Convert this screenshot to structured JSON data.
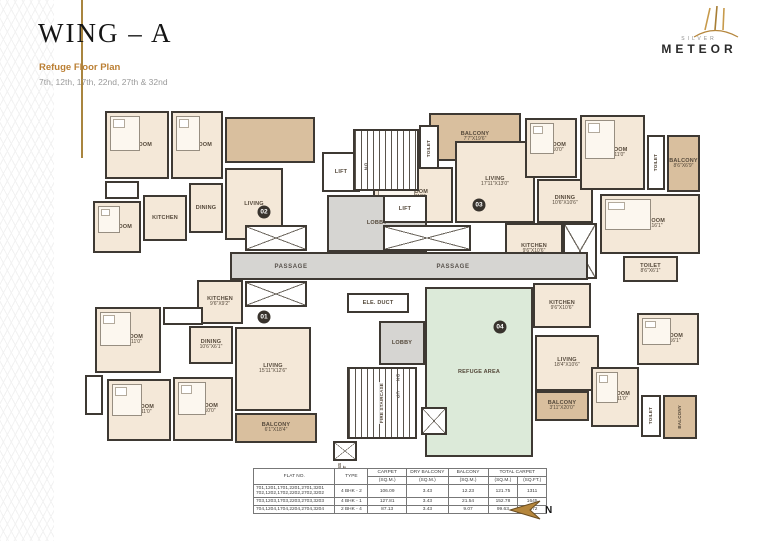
{
  "header": {
    "title": "WING – A",
    "subtitle": "Refuge Floor Plan",
    "floors": "7th, 12th, 17th, 22nd, 27th & 32nd"
  },
  "logo": {
    "brand_top": "SILVER",
    "brand": "METEOR"
  },
  "colors": {
    "accent_gold": "#b5863c",
    "wall": "#3e3933",
    "room_fill": "#f4e8d8",
    "balcony_fill": "#d9bf9e",
    "lobby_fill": "#d6d5d2",
    "refuge_fill": "#dcead9"
  },
  "compass": {
    "label": "N"
  },
  "plan": {
    "rooms": [
      {
        "name": "bedroom",
        "label": "BEDROOM",
        "dims": "",
        "x": 20,
        "y": 16,
        "w": 64,
        "h": 68,
        "fill": "room",
        "bed": true
      },
      {
        "name": "bedroom",
        "label": "BEDROOM",
        "dims": "",
        "x": 86,
        "y": 16,
        "w": 52,
        "h": 68,
        "fill": "room",
        "bed": true
      },
      {
        "name": "terrace",
        "label": "",
        "dims": "",
        "x": 140,
        "y": 22,
        "w": 90,
        "h": 46,
        "fill": "balcony"
      },
      {
        "name": "living",
        "label": "LIVING",
        "dims": "",
        "x": 140,
        "y": 73,
        "w": 58,
        "h": 72,
        "fill": "room"
      },
      {
        "name": "dining",
        "label": "DINING",
        "dims": "",
        "x": 104,
        "y": 88,
        "w": 34,
        "h": 50,
        "fill": "room"
      },
      {
        "name": "kitchen",
        "label": "KITCHEN",
        "dims": "",
        "x": 58,
        "y": 100,
        "w": 44,
        "h": 46,
        "fill": "room"
      },
      {
        "name": "toilet",
        "label": "",
        "dims": "",
        "x": 20,
        "y": 86,
        "w": 34,
        "h": 18,
        "fill": "white"
      },
      {
        "name": "bedroom",
        "label": "BEDROOM",
        "dims": "",
        "x": 8,
        "y": 106,
        "w": 48,
        "h": 52,
        "fill": "room",
        "bed": true
      },
      {
        "name": "balcony",
        "label": "BALCONY",
        "dims": "7'7\"X19'6\"",
        "x": 344,
        "y": 18,
        "w": 92,
        "h": 48,
        "fill": "balcony"
      },
      {
        "name": "toilet",
        "label": "TOILET",
        "dims": "",
        "x": 334,
        "y": 30,
        "w": 20,
        "h": 48,
        "fill": "white",
        "vert": true
      },
      {
        "name": "bedroom",
        "label": "BEDROOM",
        "dims": "13'0\"X11'0\"",
        "x": 288,
        "y": 72,
        "w": 80,
        "h": 56,
        "fill": "room",
        "bed": true
      },
      {
        "name": "living",
        "label": "LIVING",
        "dims": "17'11\"X13'0\"",
        "x": 370,
        "y": 46,
        "w": 80,
        "h": 82,
        "fill": "room"
      },
      {
        "name": "dining",
        "label": "DINING",
        "dims": "10'6\"X10'6\"",
        "x": 452,
        "y": 84,
        "w": 56,
        "h": 44,
        "fill": "room"
      },
      {
        "name": "bedroom",
        "label": "BEDROOM",
        "dims": "11'6\"X10'0\"",
        "x": 440,
        "y": 23,
        "w": 52,
        "h": 60,
        "fill": "room",
        "bed": true
      },
      {
        "name": "bedroom",
        "label": "BEDROOM",
        "dims": "13'0\"X11'0\"",
        "x": 495,
        "y": 20,
        "w": 65,
        "h": 75,
        "fill": "room",
        "bed": true
      },
      {
        "name": "toilet",
        "label": "TOILET",
        "dims": "",
        "x": 562,
        "y": 40,
        "w": 18,
        "h": 55,
        "fill": "white",
        "vert": true
      },
      {
        "name": "balcony",
        "label": "BALCONY",
        "dims": "8'6\"X6'9\"",
        "x": 582,
        "y": 40,
        "w": 33,
        "h": 57,
        "fill": "balcony"
      },
      {
        "name": "bedroom",
        "label": "BEDROOM",
        "dims": "11'6\"X16'1\"",
        "x": 515,
        "y": 99,
        "w": 100,
        "h": 60,
        "fill": "room",
        "bed": true
      },
      {
        "name": "kitchen",
        "label": "KITCHEN",
        "dims": "9'6\"X10'6\"",
        "x": 420,
        "y": 128,
        "w": 58,
        "h": 52,
        "fill": "room"
      },
      {
        "name": "toilet",
        "label": "TOILET",
        "dims": "8'6\"X6'1\"",
        "x": 538,
        "y": 161,
        "w": 55,
        "h": 26,
        "fill": "room"
      },
      {
        "name": "shaft",
        "label": "",
        "dims": "",
        "x": 478,
        "y": 128,
        "w": 34,
        "h": 56,
        "fill": "hatch"
      },
      {
        "name": "lobby",
        "label": "LOBBY",
        "dims": "",
        "x": 242,
        "y": 100,
        "w": 100,
        "h": 57,
        "fill": "lobby"
      },
      {
        "name": "passage",
        "label": "",
        "dims": "",
        "x": 145,
        "y": 157,
        "w": 358,
        "h": 28,
        "fill": "lobby"
      },
      {
        "name": "lift",
        "label": "LIFT",
        "dims": "",
        "x": 237,
        "y": 57,
        "w": 38,
        "h": 40,
        "fill": "white"
      },
      {
        "name": "staircase",
        "label": "",
        "dims": "",
        "x": 268,
        "y": 34,
        "w": 66,
        "h": 62,
        "fill": "stair"
      },
      {
        "name": "lift",
        "label": "LIFT",
        "dims": "",
        "x": 298,
        "y": 100,
        "w": 44,
        "h": 28,
        "fill": "white"
      },
      {
        "name": "shaft",
        "label": "",
        "dims": "",
        "x": 160,
        "y": 130,
        "w": 62,
        "h": 26,
        "fill": "hatch"
      },
      {
        "name": "shaft",
        "label": "",
        "dims": "",
        "x": 298,
        "y": 130,
        "w": 88,
        "h": 26,
        "fill": "hatch"
      },
      {
        "name": "shaft",
        "label": "",
        "dims": "",
        "x": 160,
        "y": 186,
        "w": 62,
        "h": 26,
        "fill": "hatch"
      },
      {
        "name": "duct",
        "label": "ELE. DUCT",
        "dims": "",
        "x": 262,
        "y": 198,
        "w": 62,
        "h": 20,
        "fill": "white"
      },
      {
        "name": "lobby",
        "label": "LOBBY",
        "dims": "",
        "x": 294,
        "y": 226,
        "w": 46,
        "h": 44,
        "fill": "lobby"
      },
      {
        "name": "fire-staircase",
        "label": "FIRE STAIRCASE",
        "dims": "",
        "x": 262,
        "y": 272,
        "w": 70,
        "h": 72,
        "fill": "stair",
        "vert": true,
        "onstripes": true
      },
      {
        "name": "duct",
        "label": "",
        "dims": "",
        "x": 248,
        "y": 346,
        "w": 24,
        "h": 20,
        "fill": "hatch",
        "out_label": "PRESS DUCT"
      },
      {
        "name": "refuge-area",
        "label": "REFUGE AREA",
        "dims": "",
        "x": 340,
        "y": 192,
        "w": 108,
        "h": 170,
        "fill": "refuge"
      },
      {
        "name": "shaft",
        "label": "",
        "dims": "",
        "x": 336,
        "y": 312,
        "w": 26,
        "h": 28,
        "fill": "hatch"
      },
      {
        "name": "kitchen",
        "label": "KITCHEN",
        "dims": "9'6\"X9'2\"",
        "x": 112,
        "y": 185,
        "w": 46,
        "h": 44,
        "fill": "room"
      },
      {
        "name": "dining",
        "label": "DINING",
        "dims": "10'6\"X6'1\"",
        "x": 104,
        "y": 231,
        "w": 44,
        "h": 38,
        "fill": "room"
      },
      {
        "name": "living",
        "label": "LIVING",
        "dims": "15'11\"X12'6\"",
        "x": 150,
        "y": 232,
        "w": 76,
        "h": 84,
        "fill": "room"
      },
      {
        "name": "bedroom",
        "label": "BEDROOM",
        "dims": "13'11\"X11'0\"",
        "x": 10,
        "y": 212,
        "w": 66,
        "h": 66,
        "fill": "room",
        "bed": true
      },
      {
        "name": "toilet",
        "label": "",
        "dims": "",
        "x": 78,
        "y": 212,
        "w": 40,
        "h": 18,
        "fill": "white"
      },
      {
        "name": "toilet",
        "label": "",
        "dims": "",
        "x": 0,
        "y": 280,
        "w": 18,
        "h": 40,
        "fill": "white"
      },
      {
        "name": "bedroom",
        "label": "BEDROOM",
        "dims": "12'0\"X11'0\"",
        "x": 22,
        "y": 284,
        "w": 64,
        "h": 62,
        "fill": "room",
        "bed": true
      },
      {
        "name": "bedroom",
        "label": "BEDROOM",
        "dims": "11'4\"X10'0\"",
        "x": 88,
        "y": 282,
        "w": 60,
        "h": 64,
        "fill": "room",
        "bed": true
      },
      {
        "name": "balcony",
        "label": "BALCONY",
        "dims": "6'1\"X18'4\"",
        "x": 150,
        "y": 318,
        "w": 82,
        "h": 30,
        "fill": "balcony"
      },
      {
        "name": "kitchen",
        "label": "KITCHEN",
        "dims": "9'6\"X10'6\"",
        "x": 448,
        "y": 188,
        "w": 58,
        "h": 45,
        "fill": "room"
      },
      {
        "name": "living",
        "label": "LIVING",
        "dims": "18'4\"X10'6\"",
        "x": 450,
        "y": 240,
        "w": 64,
        "h": 56,
        "fill": "room"
      },
      {
        "name": "balcony",
        "label": "BALCONY",
        "dims": "3'11\"X20'0\"",
        "x": 450,
        "y": 296,
        "w": 54,
        "h": 30,
        "fill": "balcony"
      },
      {
        "name": "bedroom",
        "label": "BEDROOM",
        "dims": "11'6\"X16'1\"",
        "x": 552,
        "y": 218,
        "w": 62,
        "h": 52,
        "fill": "room",
        "bed": true
      },
      {
        "name": "bedroom",
        "label": "BEDROOM",
        "dims": "13'0\"X11'0\"",
        "x": 506,
        "y": 272,
        "w": 48,
        "h": 60,
        "fill": "room",
        "bed": true
      },
      {
        "name": "toilet",
        "label": "TOILET",
        "dims": "",
        "x": 556,
        "y": 300,
        "w": 20,
        "h": 42,
        "fill": "white",
        "vert": true
      },
      {
        "name": "balcony",
        "label": "BALCONY",
        "dims": "",
        "x": 578,
        "y": 300,
        "w": 34,
        "h": 44,
        "fill": "balcony",
        "vert": true
      }
    ],
    "texts": [
      {
        "t": "PASSAGE",
        "x": 206,
        "y": 172
      },
      {
        "t": "PASSAGE",
        "x": 368,
        "y": 172
      },
      {
        "t": "DN",
        "x": 281,
        "y": 72,
        "vert": true
      },
      {
        "t": "UP",
        "x": 313,
        "y": 300,
        "vert": true
      },
      {
        "t": "DN",
        "x": 313,
        "y": 283,
        "vert": true
      }
    ],
    "unit_badges": [
      {
        "label": "02",
        "x": 179,
        "y": 117
      },
      {
        "label": "03",
        "x": 394,
        "y": 110
      },
      {
        "label": "01",
        "x": 179,
        "y": 222
      },
      {
        "label": "04",
        "x": 415,
        "y": 232
      }
    ]
  },
  "table": {
    "headers": {
      "flat_no": "FLAT NO.",
      "type": "TYPE",
      "carpet": "CARPET",
      "dry_balcony": "DRY BALCONY",
      "balcony": "BALCONY",
      "total_carpet": "TOTAL CARPET",
      "sqm": "(SQ.M.)",
      "sqft": "(SQ.FT.)"
    },
    "rows": [
      {
        "flat_no": "701,1201,1701,2201,2701,3201\n702,1202,1702,2202,2702,3202",
        "type": "4 BHK - 2",
        "carpet": "106.09",
        "dry_balcony": "3.43",
        "balcony": "12.23",
        "total_sqm": "121.75",
        "total_sqft": "1311"
      },
      {
        "flat_no": "703,1203,1703,2203,2703,3203",
        "type": "4 BHK - 1",
        "carpet": "127.81",
        "dry_balcony": "3.43",
        "balcony": "21.54",
        "total_sqm": "152.78",
        "total_sqft": "1645"
      },
      {
        "flat_no": "704,1204,1704,2204,2704,3204",
        "type": "2 BHK - 4",
        "carpet": "87.13",
        "dry_balcony": "3.43",
        "balcony": "9.07",
        "total_sqm": "99.63",
        "total_sqft": "1072"
      }
    ]
  }
}
